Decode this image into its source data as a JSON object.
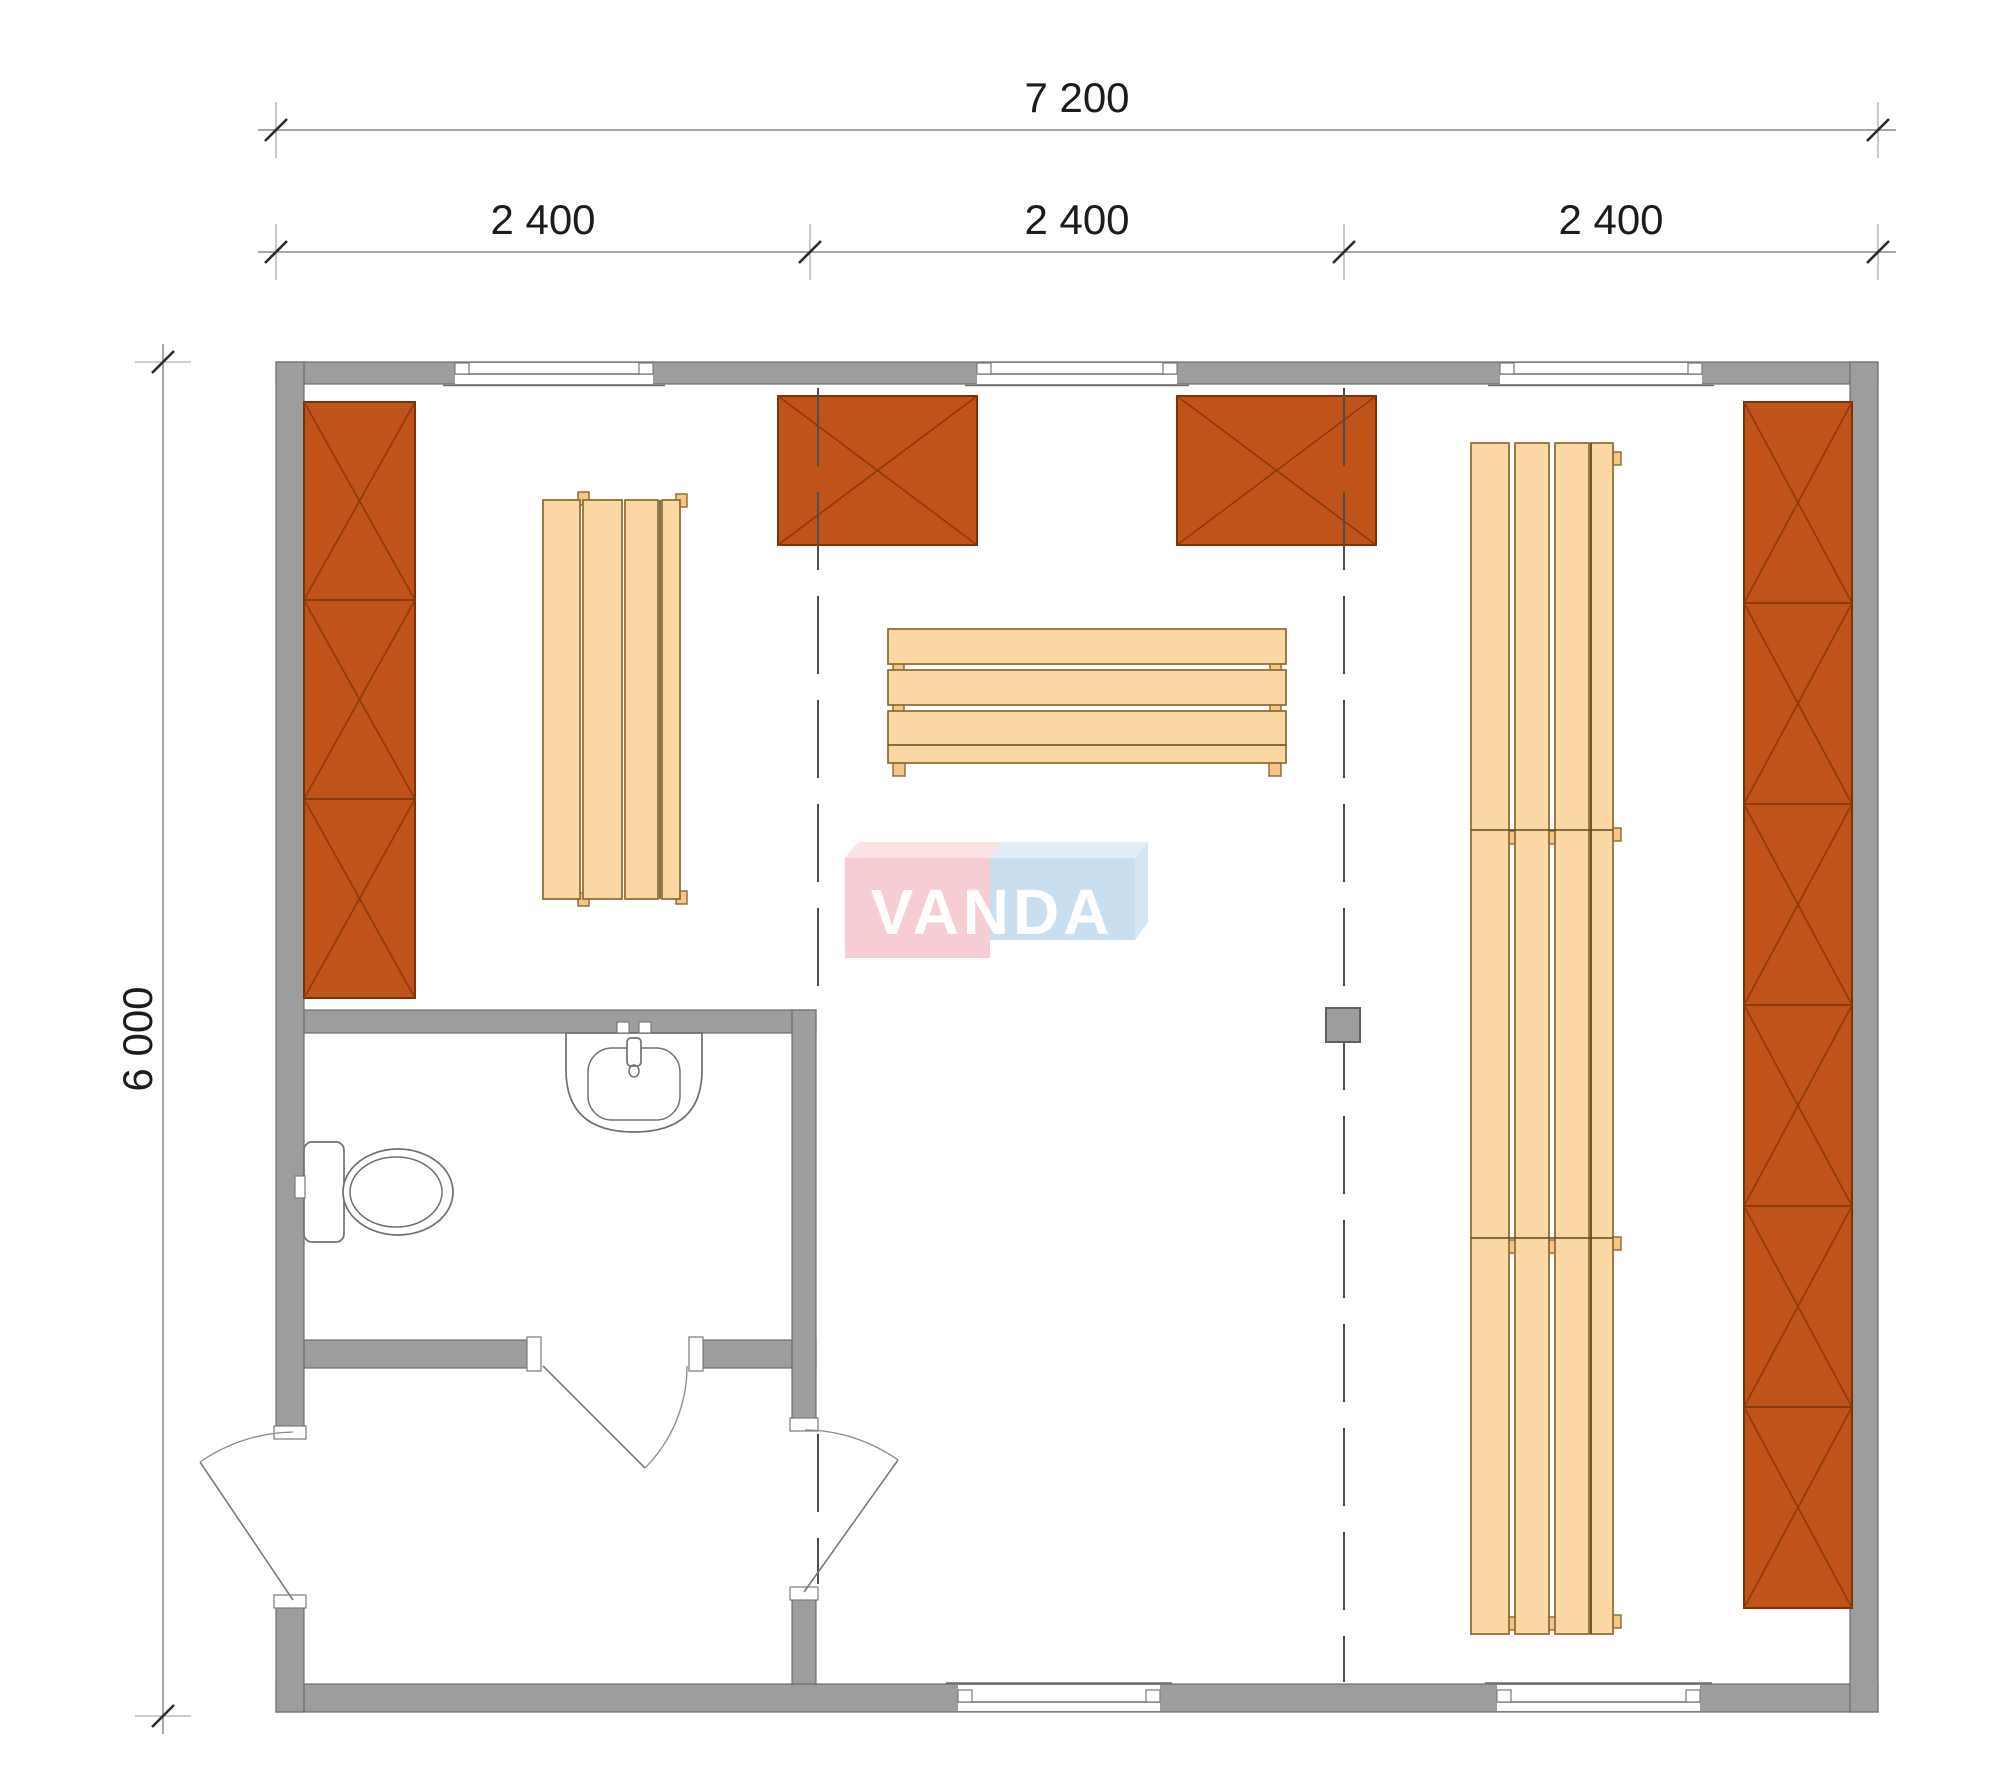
{
  "document": {
    "type": "architectural floor plan",
    "units": "mm"
  },
  "dimensions": {
    "overall_width_label": "7 200",
    "module_labels": [
      "2 400",
      "2 400",
      "2 400"
    ],
    "overall_height_label": "6 000"
  },
  "logo": {
    "text": "VANDA",
    "pink_color": "#f6cdd2",
    "blue_color": "#c9dff0",
    "text_color": "#ffffff"
  },
  "plan": {
    "building": {
      "width_mm": 7200,
      "depth_mm": 6000,
      "modules": 3
    },
    "rooms": [
      {
        "name": "main hall"
      },
      {
        "name": "bathroom",
        "fixtures": [
          "toilet",
          "washbasin"
        ]
      },
      {
        "name": "entry vestibule"
      }
    ],
    "windows": {
      "top_wall": 3,
      "bottom_wall": 2
    },
    "doors": [
      "exterior entry door",
      "vestibule to hall door",
      "bathroom door"
    ],
    "furniture": [
      {
        "name": "left wall cabinet",
        "sections": 3
      },
      {
        "name": "right wall cabinet",
        "sections": 6
      },
      {
        "name": "heater box left",
        "symbol": "crossed box"
      },
      {
        "name": "heater box right",
        "symbol": "crossed box"
      },
      {
        "name": "bench left",
        "slats": 4
      },
      {
        "name": "bench center",
        "boards": 4
      },
      {
        "name": "bench column right",
        "segments": 3,
        "slats": 4
      },
      {
        "name": "support post",
        "count": 1
      }
    ]
  },
  "colors": {
    "wall": "#9d9d9d",
    "cabinet_orange": "#c0531a",
    "bench_wood": "#fbd7a4",
    "module_line": "#4f4f4f",
    "dimension_text": "#1c1c1c"
  }
}
